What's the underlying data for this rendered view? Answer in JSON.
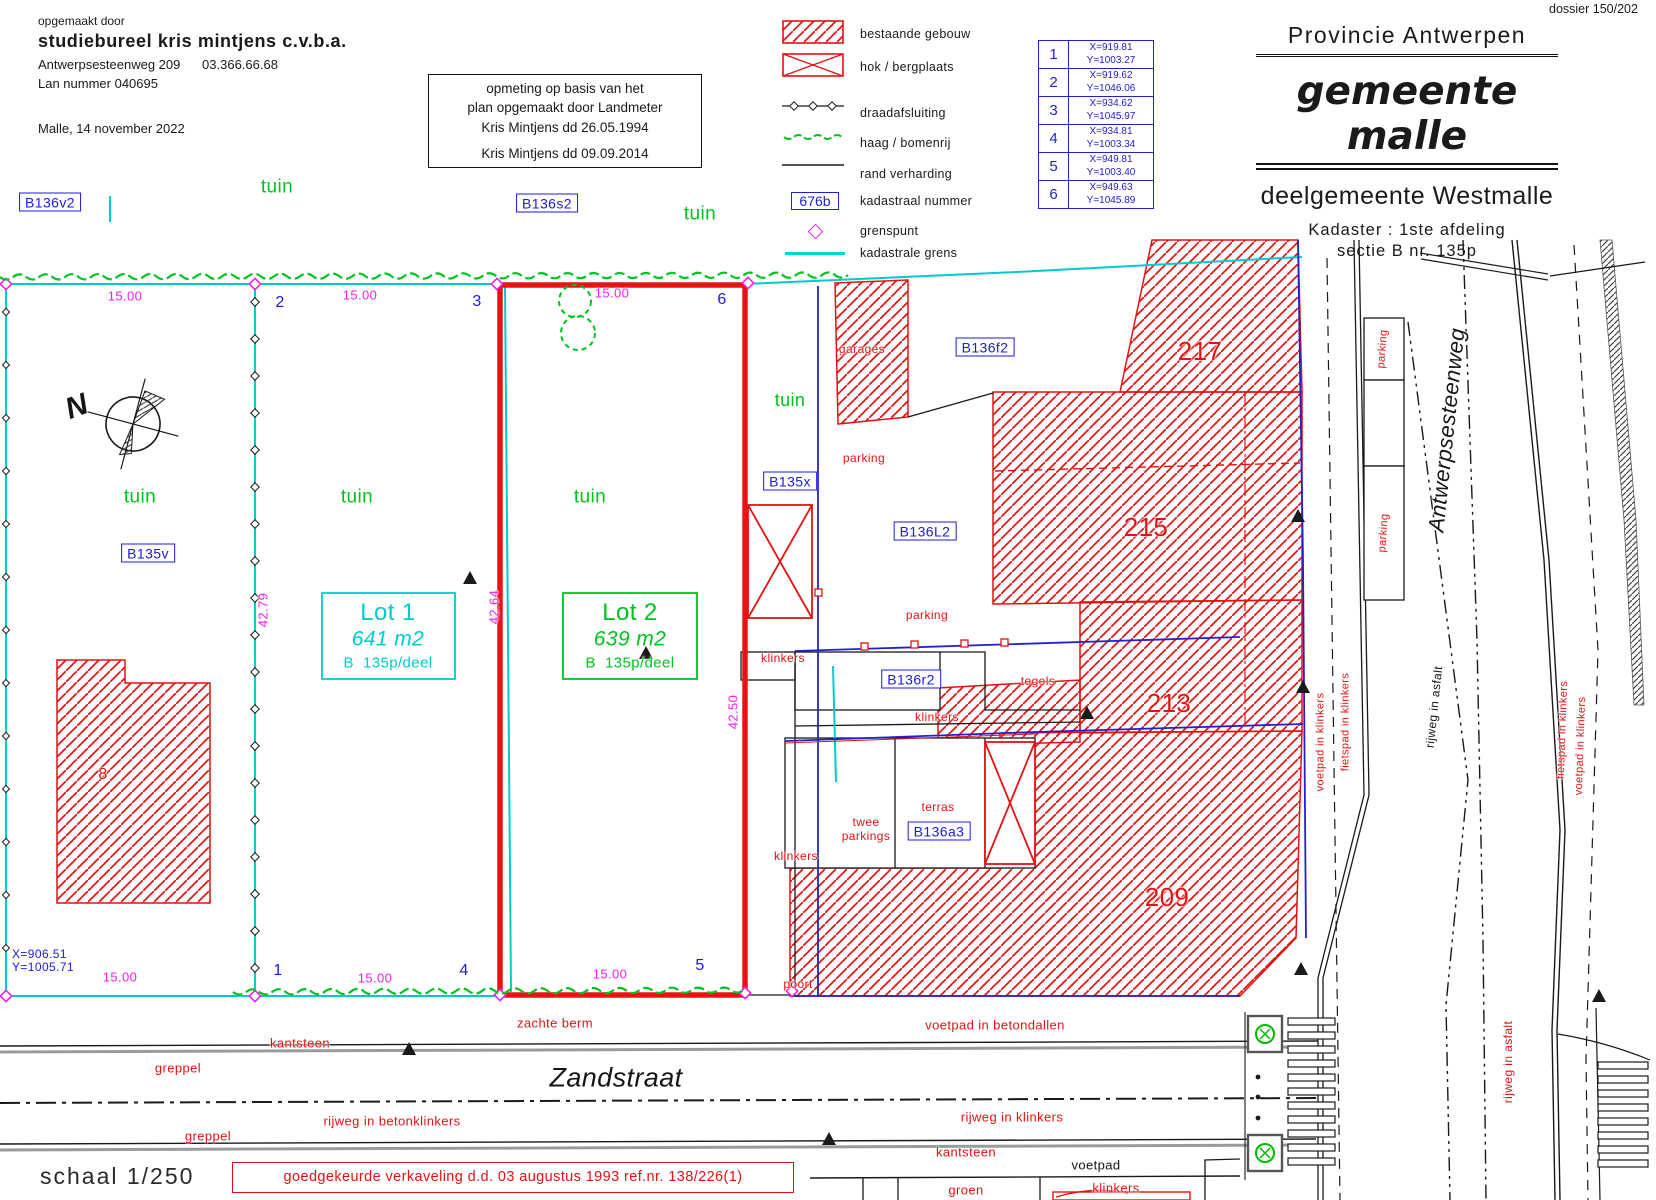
{
  "header": {
    "dossier": "dossier 150/202",
    "author_block": {
      "intro": "opgemaakt door",
      "company": "studiebureel kris mintjens  c.v.b.a.",
      "address": "Antwerpsesteenweg 209      03.366.66.68",
      "license": "Lan nummer 040695",
      "place_date": "Malle, 14  november 2022"
    },
    "survey_note": [
      "opmeting op basis van het",
      "plan opgemaakt door Landmeter",
      "Kris Mintjens dd 26.05.1994",
      "Kris Mintjens dd 09.09.2014"
    ],
    "title_block": {
      "province": "Provincie Antwerpen",
      "municipality": "gemeente malle",
      "sub_municipality": "deelgemeente Westmalle",
      "cadastre_line1": "Kadaster : 1ste afdeling",
      "cadastre_line2": "sectie B  nr. 135p"
    }
  },
  "legend": {
    "items": [
      {
        "symbol": "hatched-box",
        "label": "bestaande gebouw"
      },
      {
        "symbol": "crossed-box",
        "label": "hok / bergplaats"
      },
      {
        "symbol": "wire-line",
        "label": "draadafsluiting"
      },
      {
        "symbol": "hedge-line",
        "label": "haag / bomenrij"
      },
      {
        "symbol": "edge-line",
        "label": "rand verharding"
      },
      {
        "symbol": "parcel-box",
        "label": "kadastraal nummer",
        "example": "676b"
      },
      {
        "symbol": "boundary-point",
        "label": "grenspunt"
      },
      {
        "symbol": "cadastral-line",
        "label": "kadastrale grens"
      }
    ]
  },
  "coordinate_table": {
    "rows": [
      {
        "nr": "1",
        "x": "X=919.81",
        "y": "Y=1003.27"
      },
      {
        "nr": "2",
        "x": "X=919.62",
        "y": "Y=1046.06"
      },
      {
        "nr": "3",
        "x": "X=934.62",
        "y": "Y=1045.97"
      },
      {
        "nr": "4",
        "x": "X=934.81",
        "y": "Y=1003.34"
      },
      {
        "nr": "5",
        "x": "X=949.81",
        "y": "Y=1003.40"
      },
      {
        "nr": "6",
        "x": "X=949.63",
        "y": "Y=1045.89"
      }
    ]
  },
  "footer": {
    "scale": "schaal 1/250",
    "approval": "goedgekeurde verkaveling d.d. 03 augustus 1993 ref.nr. 138/226(1)"
  },
  "plan": {
    "palette": {
      "red": "#e31212",
      "blue": "#1b1bdf",
      "green": "#00c31f",
      "cyan": "#00cccc",
      "magenta": "#f020e8",
      "black": "#151515"
    },
    "labels": [
      {
        "id": "b136v2",
        "t": "B136v2",
        "x": 50,
        "y": 202,
        "c": "blue",
        "s": 14,
        "box": true
      },
      {
        "id": "tuin-top-left",
        "t": "tuin",
        "x": 277,
        "y": 187,
        "c": "green",
        "s": 19
      },
      {
        "id": "b136s2",
        "t": "B136s2",
        "x": 547,
        "y": 203,
        "c": "blue",
        "s": 14,
        "box": true
      },
      {
        "id": "tuin-top-mid",
        "t": "tuin",
        "x": 700,
        "y": 214,
        "c": "green",
        "s": 19
      },
      {
        "id": "dim-top-1",
        "t": "15.00",
        "x": 125,
        "y": 296,
        "c": "magenta",
        "s": 13
      },
      {
        "id": "pt-2",
        "t": "2",
        "x": 280,
        "y": 303,
        "c": "blue",
        "s": 16
      },
      {
        "id": "dim-top-2",
        "t": "15.00",
        "x": 360,
        "y": 295,
        "c": "magenta",
        "s": 13
      },
      {
        "id": "pt-3",
        "t": "3",
        "x": 477,
        "y": 302,
        "c": "blue",
        "s": 16
      },
      {
        "id": "dim-top-3",
        "t": "15.00",
        "x": 612,
        "y": 293,
        "c": "magenta",
        "s": 13
      },
      {
        "id": "pt-6",
        "t": "6",
        "x": 722,
        "y": 300,
        "c": "blue",
        "s": 16
      },
      {
        "id": "compass-n",
        "t": "N",
        "x": 77,
        "y": 407,
        "c": "black",
        "s": 30,
        "i": true,
        "bold": true,
        "r": -20
      },
      {
        "id": "tuin-parcel-left",
        "t": "tuin",
        "x": 140,
        "y": 497,
        "c": "green",
        "s": 19
      },
      {
        "id": "b135v",
        "t": "B135v",
        "x": 148,
        "y": 553,
        "c": "blue",
        "s": 14,
        "box": true
      },
      {
        "id": "tuin-lot1",
        "t": "tuin",
        "x": 357,
        "y": 497,
        "c": "green",
        "s": 19
      },
      {
        "id": "tuin-lot2",
        "t": "tuin",
        "x": 590,
        "y": 497,
        "c": "green",
        "s": 19
      },
      {
        "id": "dim-4279",
        "t": "42.79",
        "x": 263,
        "y": 610,
        "c": "magenta",
        "s": 13,
        "r": -90
      },
      {
        "id": "dim-4264",
        "t": "42.64",
        "x": 494,
        "y": 607,
        "c": "magenta",
        "s": 13,
        "r": -90
      },
      {
        "id": "dim-4250",
        "t": "42.50",
        "x": 733,
        "y": 712,
        "c": "magenta",
        "s": 13,
        "r": -90
      },
      {
        "id": "lot1-title",
        "t": "Lot 1",
        "x": 388,
        "y": 613,
        "c": "cyan",
        "s": 24
      },
      {
        "id": "lot1-area",
        "t": "641 m2",
        "x": 388,
        "y": 639,
        "c": "cyan",
        "s": 21,
        "i": true
      },
      {
        "id": "lot1-parcel",
        "t": "B  135p/deel",
        "x": 388,
        "y": 663,
        "c": "cyan",
        "s": 15
      },
      {
        "id": "lot2-title",
        "t": "Lot 2",
        "x": 630,
        "y": 613,
        "c": "green",
        "s": 24
      },
      {
        "id": "lot2-area",
        "t": "639 m2",
        "x": 630,
        "y": 639,
        "c": "green",
        "s": 21,
        "i": true
      },
      {
        "id": "lot2-parcel",
        "t": "B  135p/deel",
        "x": 630,
        "y": 663,
        "c": "green",
        "s": 15
      },
      {
        "id": "bldg-8",
        "t": "8",
        "x": 103,
        "y": 775,
        "c": "red",
        "s": 16
      },
      {
        "id": "coord-pt-x",
        "t": "X=906.51",
        "x": 12,
        "y": 954,
        "c": "blue",
        "s": 12,
        "al": "l"
      },
      {
        "id": "coord-pt-y",
        "t": "Y=1005.71",
        "x": 12,
        "y": 967,
        "c": "blue",
        "s": 12,
        "al": "l"
      },
      {
        "id": "pt-1",
        "t": "1",
        "x": 278,
        "y": 971,
        "c": "blue",
        "s": 16
      },
      {
        "id": "dim-bot-1",
        "t": "15.00",
        "x": 120,
        "y": 977,
        "c": "magenta",
        "s": 13
      },
      {
        "id": "pt-4",
        "t": "4",
        "x": 464,
        "y": 971,
        "c": "blue",
        "s": 16
      },
      {
        "id": "dim-bot-2",
        "t": "15.00",
        "x": 375,
        "y": 978,
        "c": "magenta",
        "s": 13
      },
      {
        "id": "pt-5",
        "t": "5",
        "x": 700,
        "y": 966,
        "c": "blue",
        "s": 16
      },
      {
        "id": "dim-bot-3",
        "t": "15.00",
        "x": 610,
        "y": 974,
        "c": "magenta",
        "s": 13
      },
      {
        "id": "tuin-strip",
        "t": "tuin",
        "x": 790,
        "y": 400,
        "c": "green",
        "s": 18
      },
      {
        "id": "b135x",
        "t": "B135x",
        "x": 790,
        "y": 481,
        "c": "blue",
        "s": 14,
        "box": true
      },
      {
        "id": "klinkers-strip-1",
        "t": "klinkers",
        "x": 783,
        "y": 658,
        "c": "red",
        "s": 12
      },
      {
        "id": "klinkers-strip-2",
        "t": "klinkers",
        "x": 796,
        "y": 856,
        "c": "red",
        "s": 12
      },
      {
        "id": "poort",
        "t": "poort",
        "x": 798,
        "y": 984,
        "c": "red",
        "s": 12
      },
      {
        "id": "garages",
        "t": "garages",
        "x": 862,
        "y": 349,
        "c": "red",
        "s": 12
      },
      {
        "id": "b136f2",
        "t": "B136f2",
        "x": 985,
        "y": 347,
        "c": "blue",
        "s": 14,
        "box": true
      },
      {
        "id": "parking-1",
        "t": "parking",
        "x": 864,
        "y": 458,
        "c": "red",
        "s": 12
      },
      {
        "id": "b136l2",
        "t": "B136L2",
        "x": 925,
        "y": 531,
        "c": "blue",
        "s": 14,
        "box": true
      },
      {
        "id": "parking-2",
        "t": "parking",
        "x": 927,
        "y": 615,
        "c": "red",
        "s": 12
      },
      {
        "id": "b136r2",
        "t": "B136r2",
        "x": 911,
        "y": 679,
        "c": "blue",
        "s": 14,
        "box": true
      },
      {
        "id": "tegels",
        "t": "tegels",
        "x": 1038,
        "y": 681,
        "c": "red",
        "s": 12
      },
      {
        "id": "klinkers-yard",
        "t": "klinkers",
        "x": 937,
        "y": 717,
        "c": "red",
        "s": 12
      },
      {
        "id": "twee",
        "t": "twee",
        "x": 866,
        "y": 822,
        "c": "red",
        "s": 12
      },
      {
        "id": "parkings",
        "t": "parkings",
        "x": 866,
        "y": 836,
        "c": "red",
        "s": 12
      },
      {
        "id": "terras",
        "t": "terras",
        "x": 938,
        "y": 807,
        "c": "red",
        "s": 12
      },
      {
        "id": "b136a3",
        "t": "B136a3",
        "x": 939,
        "y": 831,
        "c": "blue",
        "s": 14,
        "box": true
      },
      {
        "id": "nr-217",
        "t": "217",
        "x": 1200,
        "y": 351,
        "c": "red",
        "s": 26
      },
      {
        "id": "nr-215",
        "t": "215",
        "x": 1146,
        "y": 527,
        "c": "red",
        "s": 26
      },
      {
        "id": "nr-213",
        "t": "213",
        "x": 1169,
        "y": 703,
        "c": "red",
        "s": 26
      },
      {
        "id": "nr-209",
        "t": "209",
        "x": 1167,
        "y": 897,
        "c": "red",
        "s": 26
      },
      {
        "id": "zachte-berm",
        "t": "zachte berm",
        "x": 555,
        "y": 1023,
        "c": "red",
        "s": 13
      },
      {
        "id": "kantsteen-left",
        "t": "kantsteen",
        "x": 300,
        "y": 1043,
        "c": "red",
        "s": 13
      },
      {
        "id": "greppel-1",
        "t": "greppel",
        "x": 178,
        "y": 1068,
        "c": "red",
        "s": 13
      },
      {
        "id": "zandstraat",
        "t": "Zandstraat",
        "x": 616,
        "y": 1078,
        "c": "black",
        "s": 27,
        "i": true
      },
      {
        "id": "rijweg-betonklinkers",
        "t": "rijweg in betonklinkers",
        "x": 392,
        "y": 1121,
        "c": "red",
        "s": 13
      },
      {
        "id": "greppel-2",
        "t": "greppel",
        "x": 208,
        "y": 1136,
        "c": "red",
        "s": 13
      },
      {
        "id": "voetpad-betondallen",
        "t": "voetpad in betondallen",
        "x": 995,
        "y": 1025,
        "c": "red",
        "s": 13
      },
      {
        "id": "rijweg-klinkers",
        "t": "rijweg in klinkers",
        "x": 1012,
        "y": 1117,
        "c": "red",
        "s": 13
      },
      {
        "id": "kantsteen-right",
        "t": "kantsteen",
        "x": 966,
        "y": 1152,
        "c": "red",
        "s": 13
      },
      {
        "id": "voetpad",
        "t": "voetpad",
        "x": 1096,
        "y": 1165,
        "c": "black",
        "s": 13
      },
      {
        "id": "groen",
        "t": "groen",
        "x": 966,
        "y": 1190,
        "c": "red",
        "s": 13
      },
      {
        "id": "klinkers-bottom",
        "t": "klinkers",
        "x": 1116,
        "y": 1188,
        "c": "red",
        "s": 13
      },
      {
        "id": "voetpad-klinkers-left",
        "t": "voetpad in klinkers",
        "x": 1321,
        "y": 742,
        "c": "red",
        "s": 11,
        "r": -90
      },
      {
        "id": "fietspad-klinkers-left",
        "t": "fietspad in klinkers",
        "x": 1346,
        "y": 722,
        "c": "red",
        "s": 11,
        "r": -90
      },
      {
        "id": "parking-road-1",
        "t": "parking",
        "x": 1383,
        "y": 349,
        "c": "red",
        "s": 11,
        "r": -86
      },
      {
        "id": "parking-road-2",
        "t": "parking",
        "x": 1384,
        "y": 533,
        "c": "red",
        "s": 11,
        "r": -86
      },
      {
        "id": "antwerpsesteenweg",
        "t": "Antwerpsesteenweg",
        "x": 1447,
        "y": 430,
        "c": "black",
        "s": 22,
        "i": true,
        "r": -84
      },
      {
        "id": "rijweg-asfalt-1",
        "t": "rijweg in asfalt",
        "x": 1434,
        "y": 707,
        "c": "black",
        "s": 12,
        "r": -84
      },
      {
        "id": "fietspad-klinkers-right",
        "t": "fietspad in klinkers",
        "x": 1563,
        "y": 730,
        "c": "red",
        "s": 11,
        "r": -88
      },
      {
        "id": "voetpad-klinkers-right",
        "t": "voetpad in klinkers",
        "x": 1581,
        "y": 746,
        "c": "red",
        "s": 11,
        "r": -88
      },
      {
        "id": "rijweg-asfalt-2",
        "t": "rijweg in asfalt",
        "x": 1508,
        "y": 1062,
        "c": "red",
        "s": 12,
        "r": -90
      }
    ]
  }
}
